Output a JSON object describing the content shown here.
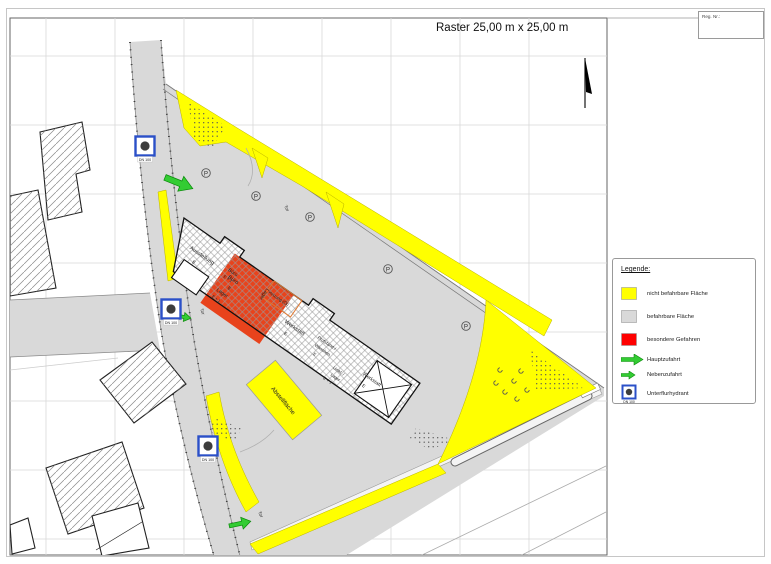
{
  "header": {
    "title": "Raster 25,00 m x 25,00 m",
    "reg": "Reg. Nr.:"
  },
  "legend": {
    "title": "Legende:",
    "items": [
      {
        "label": "nicht befahrbare Fläche",
        "swatch": "yellow-square"
      },
      {
        "label": "befahrbare Fläche",
        "swatch": "gray-square"
      },
      {
        "label": "besondere Gefahren",
        "swatch": "red-square"
      },
      {
        "label": "Hauptzufahrt",
        "swatch": "large-green-arrow"
      },
      {
        "label": "Nebenzufahrt",
        "swatch": "small-green-arrow"
      },
      {
        "label": "Unterflurhydrant",
        "swatch": "hydrant-symbol"
      }
    ]
  },
  "map": {
    "rooms": {
      "ausstellung": "Ausstellung",
      "buero": "Büro",
      "heizung": "Heizung (Öl)",
      "lager": "Lager",
      "werkstatt": "Werkstatt",
      "pruefstand": "Prüfstand /",
      "waschen": "Waschen",
      "umkl": "Umkl. /",
      "e": "E",
      "e1": "E + 1"
    },
    "abstellflaeche": "Abstellfläche",
    "tor": "Tor",
    "dn": "DN 100",
    "p": "P"
  },
  "colors": {
    "yellow": "#ffff00",
    "surface": "#d9d9d9",
    "red_zone": "#e8431c",
    "legend_red": "#ff0000",
    "arrow_green": "#33cc33",
    "hydrant_blue": "#2b50c8"
  }
}
